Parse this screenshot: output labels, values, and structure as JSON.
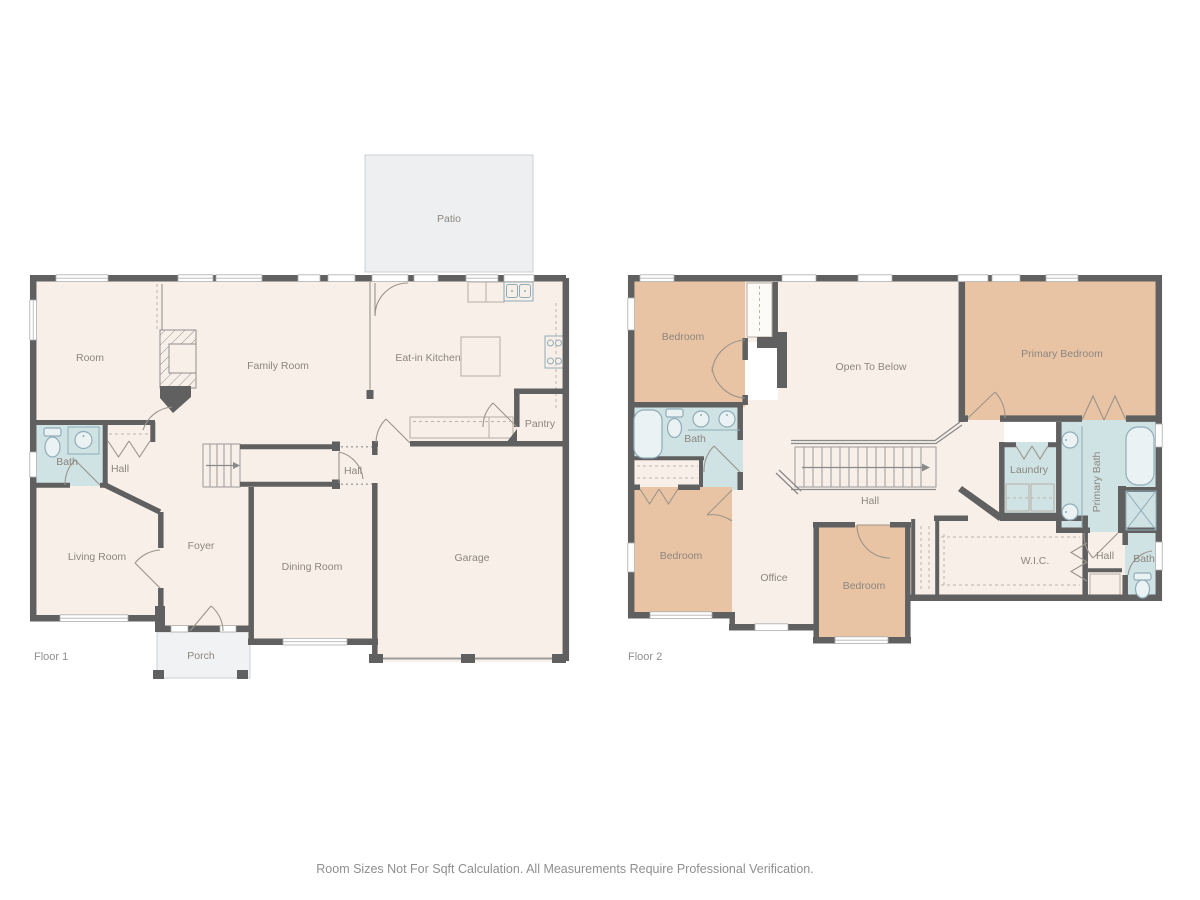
{
  "colors": {
    "background": "#ffffff",
    "wall": "#606060",
    "floor_cream": "#f8efe8",
    "bedroom_tan": "#e9c4a4",
    "bath_blue": "#cfe2e4",
    "patio_gray": "#edeff0",
    "porch_gray": "#f1f2f3",
    "label_text": "#8c867f",
    "floor_label_text": "#8f8f8f",
    "footer_text": "#8f8f8f",
    "fixture_line": "#8fadb8",
    "furniture_line": "#bcb4a9"
  },
  "footer": {
    "disclaimer": "Room Sizes Not For Sqft Calculation. All Measurements Require Professional Verification."
  },
  "floor1": {
    "name": "Floor 1",
    "labels": {
      "patio": "Patio",
      "room": "Room",
      "family_room": "Family Room",
      "eat_in_kitchen": "Eat-in Kitchen",
      "pantry": "Pantry",
      "bath": "Bath",
      "hall_left": "Hall",
      "hall_right": "Hall",
      "foyer": "Foyer",
      "living_room": "Living Room",
      "dining_room": "Dining Room",
      "garage": "Garage",
      "porch": "Porch"
    }
  },
  "floor2": {
    "name": "Floor 2",
    "labels": {
      "bedroom_top_left": "Bedroom",
      "open_to_below": "Open To Below",
      "primary_bedroom": "Primary Bedroom",
      "bath": "Bath",
      "laundry": "Laundry",
      "primary_bath": "Primary Bath",
      "hall": "Hall",
      "bedroom_bottom_left": "Bedroom",
      "office": "Office",
      "bedroom_bottom_center": "Bedroom",
      "wic": "W.I.C.",
      "hall_small": "Hall",
      "bath_small": "Bath"
    }
  }
}
